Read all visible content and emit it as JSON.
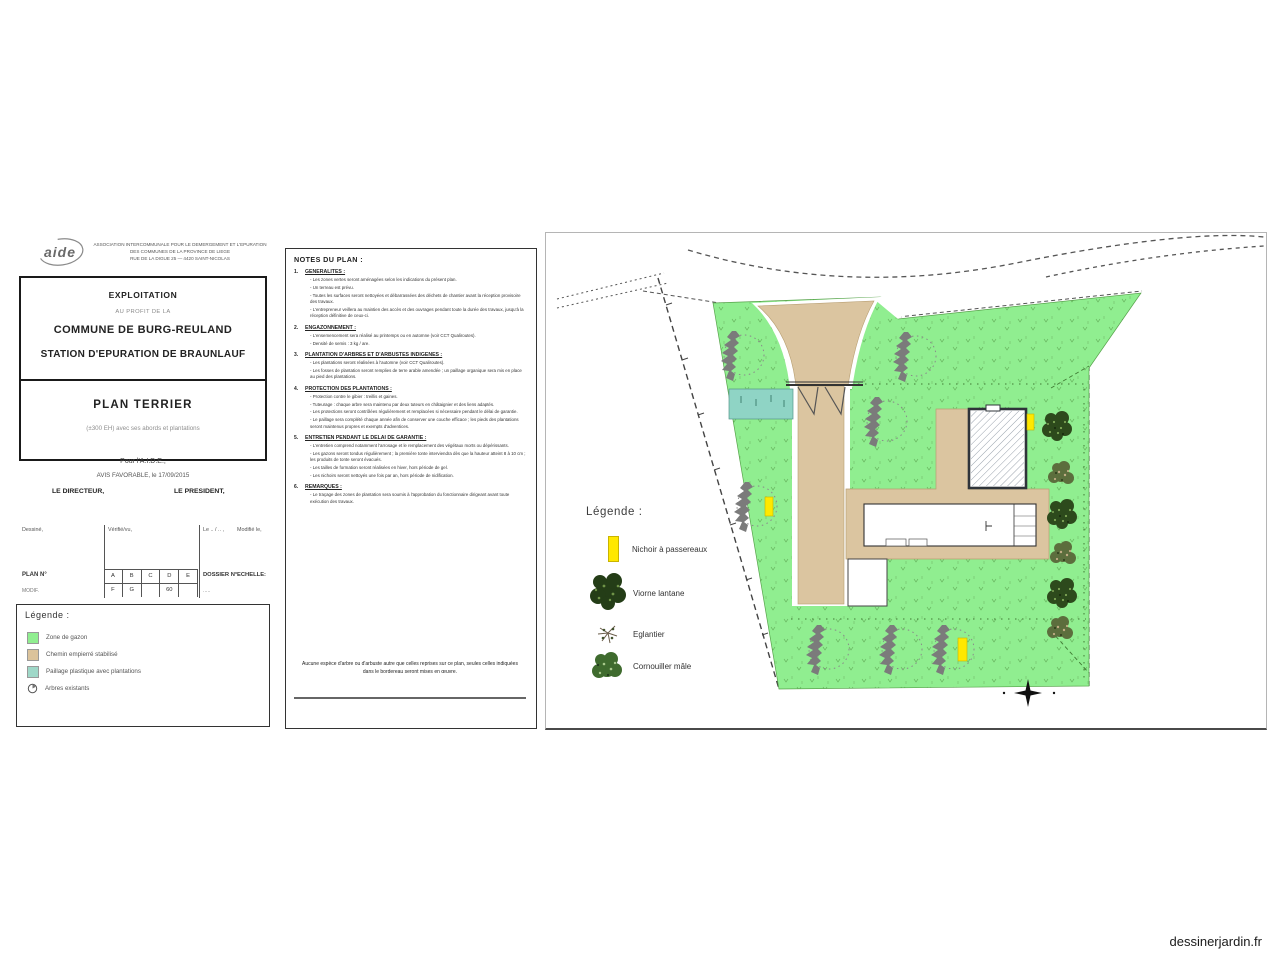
{
  "watermark": "dessinerjardin.fr",
  "title_block": {
    "logo": "aide",
    "org_line1": "ASSOCIATION INTERCOMMUNALE POUR LE DEMERGEMENT ET L'EPURATION",
    "org_line2": "DES COMMUNES DE LA PROVINCE DE LIEGE",
    "org_line3": "RUE DE LA DIGUE 25 — 4420 SAINT-NICOLAS",
    "exploitation": "EXPLOITATION",
    "au_profit": "AU PROFIT DE LA",
    "commune": "COMMUNE DE BURG-REULAND",
    "station": "STATION D'EPURATION DE BRAUNLAUF",
    "plan_title": "PLAN TERRIER",
    "plan_subtitle": "(±300 EH) avec ses abords et plantations",
    "approval": {
      "pour": "Pour l'A.I.D.E.,",
      "avis": "AVIS FAVORABLE, le 17/09/2015",
      "directeur": "LE DIRECTEUR,",
      "president": "LE PRESIDENT,"
    },
    "table": {
      "lab_dessine": "Dessiné,",
      "lab_verifie": "Vérifié/vu,",
      "lab_le": "Le .. / .. ,",
      "lab_modifie": "Modifié le,",
      "plan_no": "PLAN N°",
      "modif": "MODIF.",
      "letters_row1": [
        "A",
        "B",
        "C",
        "D",
        "E"
      ],
      "letters_row2": [
        "F",
        "G",
        "",
        "60",
        ""
      ],
      "dossier_no": "DOSSIER N°",
      "dossier_val": ".....",
      "echelle": "ECHELLE:"
    },
    "legend": {
      "title": "Légende :",
      "items": [
        {
          "label": "Zone de gazon",
          "color": "#90EE90"
        },
        {
          "label": "Chemin empierré stabilisé",
          "color": "#DBC39B"
        },
        {
          "label": "Paillage plastique avec plantations",
          "color": "#9FD8C8"
        },
        {
          "label": "Arbres existants",
          "color": "#ffffff"
        }
      ]
    }
  },
  "notes": {
    "title": "NOTES DU PLAN :",
    "sections": [
      {
        "num": "1.",
        "heading": "GENERALITES :",
        "bullets": [
          "Les zones vertes seront aménagées selon les indications du présent plan.",
          "Un terreau est prévu.",
          "Toutes les surfaces seront nettoyées et débarrassées des déchets de chantier avant la réception provisoire des travaux.",
          "L'entrepreneur veillera au maintien des accès et des ouvrages pendant toute la durée des travaux, jusqu'à la réception définitive de ceux-ci."
        ]
      },
      {
        "num": "2.",
        "heading": "ENGAZONNEMENT :",
        "bullets": [
          "L'ensemencement sera réalisé au printemps ou en automne (voir CCT Qualiroutes).",
          "Densité de semis : 3 kg / are."
        ]
      },
      {
        "num": "3.",
        "heading": "PLANTATION D'ARBRES ET D'ARBUSTES INDIGENES :",
        "bullets": [
          "Les plantations seront réalisées à l'automne (voir CCT Qualiroutes).",
          "Les fosses de plantation seront remplies de terre arable amendée ; un paillage organique sera mis en place au pied des plantations."
        ]
      },
      {
        "num": "4.",
        "heading": "PROTECTION DES PLANTATIONS :",
        "bullets": [
          "Protection contre le gibier : treillis et gaines.",
          "Tuteurage : chaque arbre sera maintenu par deux tuteurs en châtaignier et des liens adaptés.",
          "Les protections seront contrôlées régulièrement et remplacées si nécessaire pendant le délai de garantie.",
          "Le paillage sera complété chaque année afin de conserver une couche efficace ; les pieds des plantations seront maintenus propres et exempts d'adventices."
        ]
      },
      {
        "num": "5.",
        "heading": "ENTRETIEN PENDANT LE DELAI DE GARANTIE :",
        "bullets": [
          "L'entretien comprend notamment l'arrosage et le remplacement des végétaux morts ou dépérissants.",
          "Les gazons seront tondus régulièrement ; la première tonte interviendra dès que la hauteur atteint 8 à 10 cm ; les produits de tonte seront évacués.",
          "Les tailles de formation seront réalisées en hiver, hors période de gel.",
          "Les nichoirs seront nettoyés une fois par an, hors période de nidification."
        ]
      },
      {
        "num": "6.",
        "heading": "REMARQUES :",
        "bullets": [
          "Le traçage des zones de plantation sera soumis à l'approbation du fonctionnaire dirigeant avant toute exécution des travaux."
        ]
      }
    ],
    "footnote_l1": "Aucune espèce d'arbre ou d'arbuste autre que celles reprises sur ce plan, seules celles indiquées",
    "footnote_l2": "dans le bordereau seront mises en œuvre."
  },
  "plan": {
    "legend_title": "Légende :",
    "legend_items": [
      {
        "label": "Nichoir à passereaux"
      },
      {
        "label": "Viorne lantane"
      },
      {
        "label": "Eglantier"
      },
      {
        "label": "Cornouiller mâle"
      }
    ],
    "colors": {
      "grass": "#90EE90",
      "path": "#DBC5A0",
      "water": "#8FD4C5",
      "tree_gray": "#7b7b7b",
      "nichoir_yellow": "#FFE800"
    }
  }
}
